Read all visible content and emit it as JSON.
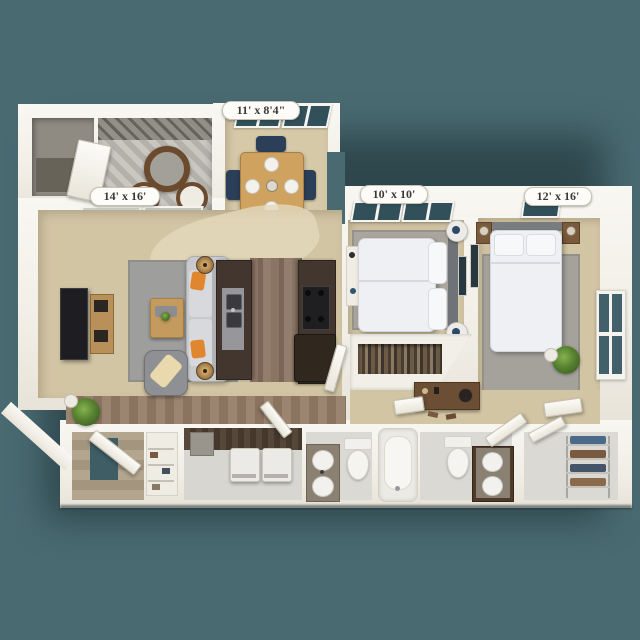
{
  "floorplan": {
    "type": "apartment-floor-plan-3d-top-view",
    "background_color": "#4A6A72",
    "wall_color": "#F5F2EB",
    "carpet_color": "#D2C5A4",
    "wood_color": "#85705F",
    "cabinet_color": "#453830",
    "accent_navy": "#2C3F58",
    "labels": {
      "dining_nook": "11' x 8'4\"",
      "living_room": "14' x 16'",
      "bedroom_1": "10' x 10'",
      "bedroom_2": "12' x 16'"
    },
    "rooms": [
      {
        "name": "patio",
        "dimensions": "14' x 16'"
      },
      {
        "name": "dining-nook",
        "dimensions": "11' x 8'4\""
      },
      {
        "name": "living-room",
        "dimensions": ""
      },
      {
        "name": "kitchen",
        "dimensions": ""
      },
      {
        "name": "bedroom-1",
        "dimensions": "10' x 10'"
      },
      {
        "name": "bedroom-2",
        "dimensions": "12' x 16'"
      },
      {
        "name": "bathroom-1",
        "dimensions": ""
      },
      {
        "name": "bathroom-2",
        "dimensions": ""
      },
      {
        "name": "laundry-closet",
        "dimensions": ""
      },
      {
        "name": "walk-in-closet",
        "dimensions": ""
      },
      {
        "name": "entry",
        "dimensions": ""
      }
    ]
  }
}
